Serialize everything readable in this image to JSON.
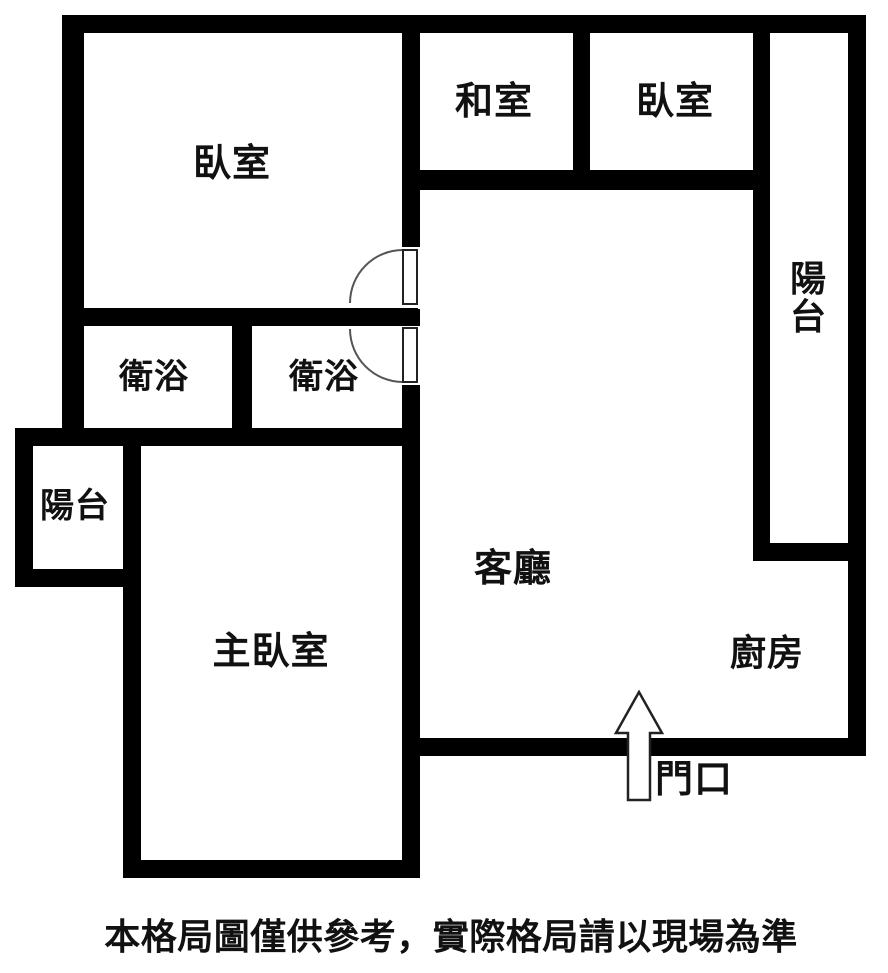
{
  "rooms": {
    "bedroom_top_left": {
      "label": "臥室"
    },
    "tatami_room": {
      "label": "和室"
    },
    "bedroom_top_right": {
      "label": "臥室"
    },
    "balcony_right": {
      "label": "陽台"
    },
    "bathroom_1": {
      "label": "衛浴"
    },
    "bathroom_2": {
      "label": "衛浴"
    },
    "balcony_left": {
      "label": "陽台"
    },
    "master_bedroom": {
      "label": "主臥室"
    },
    "living_room": {
      "label": "客廳"
    },
    "kitchen": {
      "label": "廚房"
    },
    "entrance": {
      "label": "門口"
    }
  },
  "caption": "本格局圖僅供參考，實際格局請以現場為準",
  "colors": {
    "wall": "#000000",
    "background": "#ffffff",
    "text": "#111111"
  }
}
